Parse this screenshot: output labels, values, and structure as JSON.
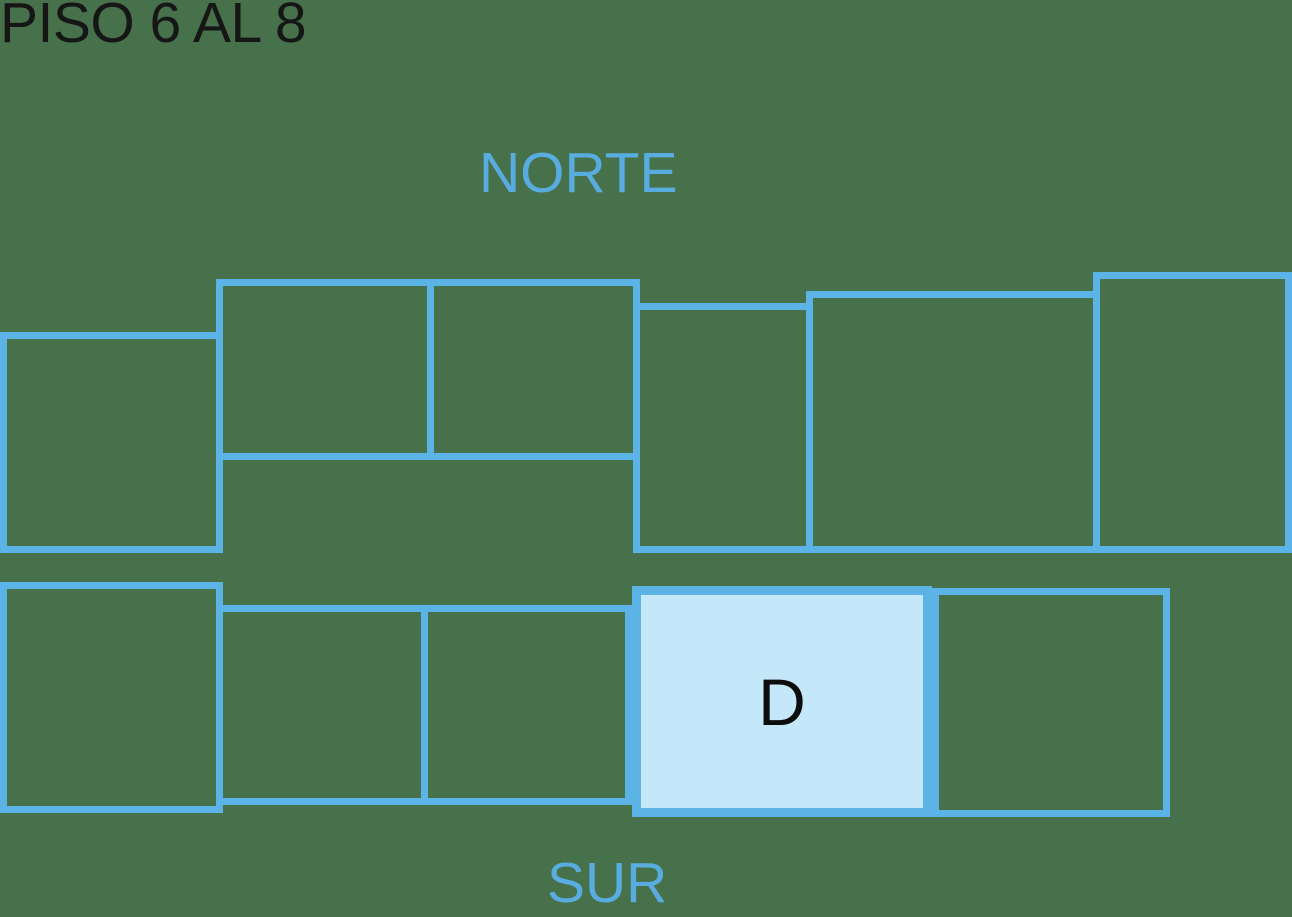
{
  "title": "PISO 6 AL 8",
  "orientation_labels": {
    "north": "NORTE",
    "south": "SUR"
  },
  "selected_unit": {
    "label": "D"
  },
  "colors": {
    "bg": "#47714A",
    "line": "#5CB4E6",
    "fill": "#C4E7F9",
    "dirText": "#58ACDF",
    "title": "#161616",
    "label": "#0D0D0D"
  },
  "floorplan": {
    "rooms": [
      {
        "side": "north",
        "x": 0,
        "y": 332,
        "w": 223,
        "h": 221,
        "border_px": 7,
        "highlighted": false,
        "label": ""
      },
      {
        "side": "north",
        "x": 216,
        "y": 279,
        "w": 218,
        "h": 181,
        "border_px": 7,
        "highlighted": false,
        "label": ""
      },
      {
        "side": "north",
        "x": 427,
        "y": 279,
        "w": 213,
        "h": 181,
        "border_px": 7,
        "highlighted": false,
        "label": ""
      },
      {
        "side": "north",
        "x": 633,
        "y": 303,
        "w": 180,
        "h": 250,
        "border_px": 7,
        "highlighted": false,
        "label": ""
      },
      {
        "side": "north",
        "x": 806,
        "y": 291,
        "w": 294,
        "h": 262,
        "border_px": 7,
        "highlighted": false,
        "label": ""
      },
      {
        "side": "north",
        "x": 1093,
        "y": 272,
        "w": 199,
        "h": 281,
        "border_px": 7,
        "highlighted": false,
        "label": ""
      },
      {
        "side": "south",
        "x": 0,
        "y": 582,
        "w": 223,
        "h": 231,
        "border_px": 7,
        "highlighted": false,
        "label": ""
      },
      {
        "side": "south",
        "x": 216,
        "y": 605,
        "w": 212,
        "h": 200,
        "border_px": 7,
        "highlighted": false,
        "label": ""
      },
      {
        "side": "south",
        "x": 421,
        "y": 605,
        "w": 211,
        "h": 200,
        "border_px": 7,
        "highlighted": false,
        "label": ""
      },
      {
        "side": "south",
        "x": 632,
        "y": 586,
        "w": 300,
        "h": 231,
        "border_px": 9,
        "highlighted": true,
        "label": "D"
      },
      {
        "side": "south",
        "x": 932,
        "y": 588,
        "w": 238,
        "h": 229,
        "border_px": 7,
        "highlighted": false,
        "label": ""
      }
    ]
  }
}
